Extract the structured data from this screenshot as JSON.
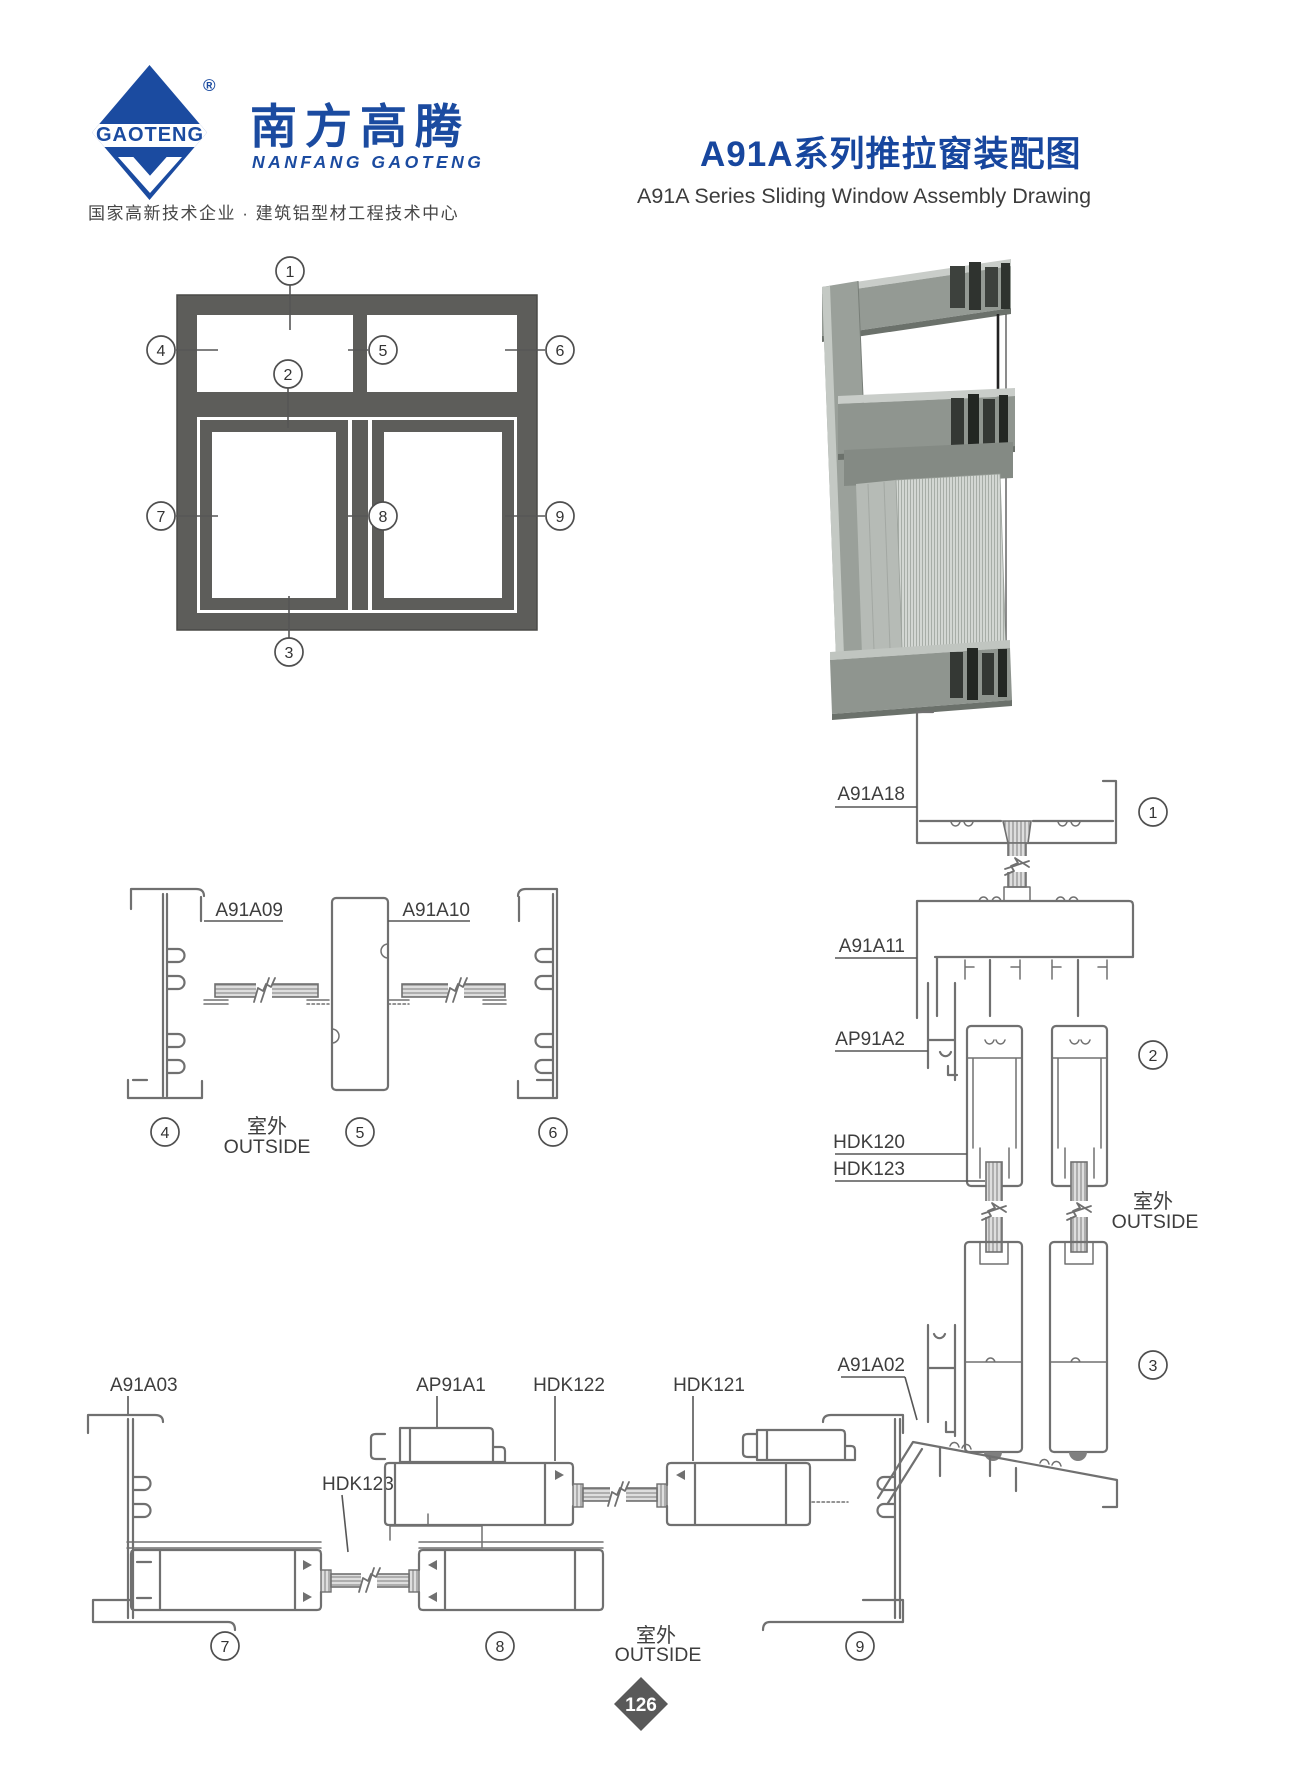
{
  "colors": {
    "brand_blue": "#1b4ba0",
    "line_gray": "#707070",
    "dark_text": "#3c3c3c",
    "frame_gray": "#5d5d5a",
    "render_gray": "#949a94",
    "badge_gray": "#595959"
  },
  "header": {
    "logo_brand": "GAOTENG",
    "logo_registered": "®",
    "logo_cn": "南方高腾",
    "logo_en": "NANFANG GAOTENG",
    "tagline": "国家高新技术企业 · 建筑铝型材工程技术中心",
    "title_cn": "A91A系列推拉窗装配图",
    "title_en": "A91A Series Sliding Window Assembly Drawing"
  },
  "callouts": {
    "c1": "1",
    "c2": "2",
    "c3": "3",
    "c4": "4",
    "c5": "5",
    "c6": "6",
    "c7": "7",
    "c8": "8",
    "c9": "9"
  },
  "labels": {
    "a91a09": "A91A09",
    "a91a10": "A91A10",
    "a91a18": "A91A18",
    "a91a11": "A91A11",
    "ap91a2": "AP91A2",
    "hdk120": "HDK120",
    "hdk123": "HDK123",
    "a91a03": "A91A03",
    "ap91a1": "AP91A1",
    "hdk122": "HDK122",
    "hdk121": "HDK121",
    "a91a02": "A91A02"
  },
  "outside": {
    "cn": "室外",
    "en": "OUTSIDE"
  },
  "footer": {
    "page": "126"
  }
}
